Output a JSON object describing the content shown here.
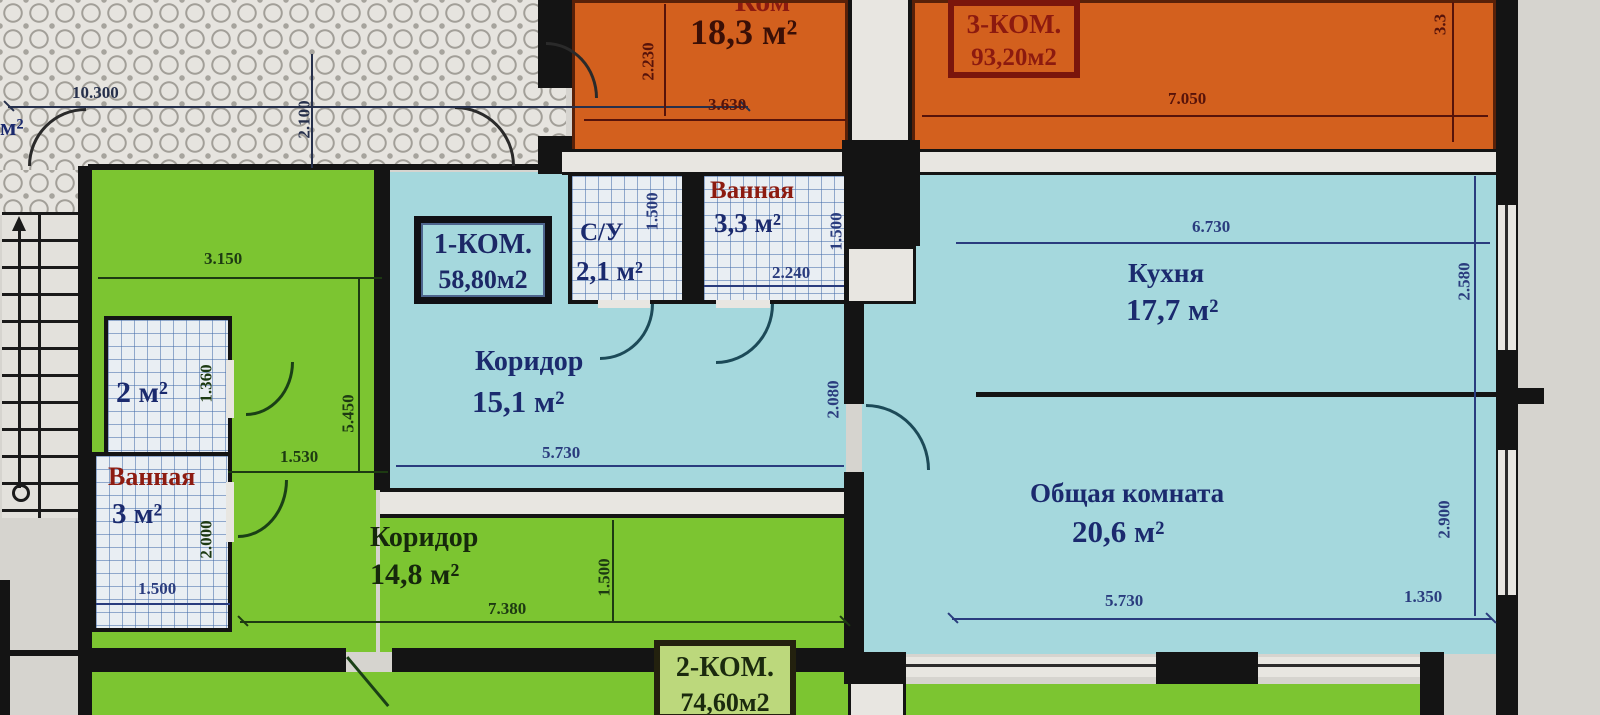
{
  "plan": {
    "badges": {
      "apt3": {
        "line1": "3-КОМ.",
        "line2": "93,20м2"
      },
      "apt1": {
        "line1": "1-КОМ.",
        "line2": "58,80м2"
      },
      "apt2": {
        "line1": "2-КОМ.",
        "line2": "74,60м2"
      }
    },
    "rooms": {
      "top_room": {
        "name": "Ком",
        "area": "18,3 м²"
      },
      "kitchen": {
        "name": "Кухня",
        "area": "17,7 м²"
      },
      "living": {
        "name": "Общая комната",
        "area": "20,6 м²"
      },
      "hall_apt1": {
        "name": "Коридор",
        "area": "15,1 м²"
      },
      "wc": {
        "name": "С/У",
        "area": "2,1 м²"
      },
      "bath_apt1": {
        "name": "Ванная",
        "area": "3,3 м²"
      },
      "closet": {
        "area": "2 м²"
      },
      "bath_apt2": {
        "name": "Ванная",
        "area": "3 м²"
      },
      "hall_apt2": {
        "name": "Коридор",
        "area": "14,8 м²"
      },
      "edge_fragment": {
        "area": "м²"
      }
    },
    "dimensions": {
      "d10300": "10.300",
      "d2100": "2.100",
      "d2230": "2.230",
      "d3630": "3.630",
      "d7050": "7.050",
      "d33": "3.3",
      "wc_1500": "1.500",
      "bath_2240": "2.240",
      "bath_1500": "1.500",
      "kit_6730": "6.730",
      "kit_2580": "2.580",
      "hall1_5730": "5.730",
      "hall1_2080": "2.080",
      "liv_5730": "5.730",
      "liv_1350": "1.350",
      "liv_2900": "2.900",
      "grn_3150": "3.150",
      "grn_1360": "1.360",
      "grn_5450": "5.450",
      "grn_1530": "1.530",
      "grn_2000": "2.000",
      "grn_1500": "1.500",
      "hall2_7380": "7.380",
      "hall2_1500": "1.500"
    },
    "colors": {
      "apt3_fill": "#d3601e",
      "apt1_fill": "#a5d8dd",
      "apt2_fill": "#7cc531",
      "wall": "#141414",
      "dim_navy": "#2a3c7e",
      "dim_maroon": "#57130a",
      "dim_green": "#1d3a12",
      "label_red": "#8d1b10",
      "label_navy": "#1b2a6e"
    }
  }
}
